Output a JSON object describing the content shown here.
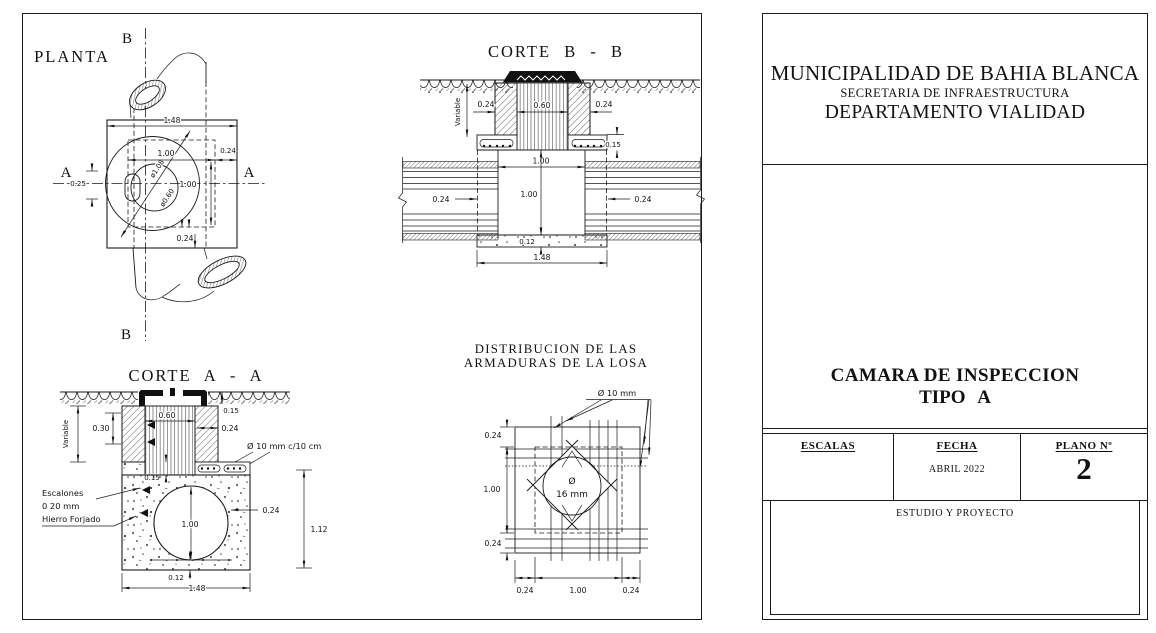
{
  "colors": {
    "line": "#1a1a1a",
    "background": "#ffffff"
  },
  "planta": {
    "title": "PLANTA",
    "section_b": "B",
    "section_a": "A",
    "dim_total_width": "1.48",
    "dim_inner_width": "1.00",
    "dim_wall_right": "0.24",
    "dim_inner_height": "1.00",
    "dim_step": "0.25",
    "dim_wall_bottom": "0.24",
    "dia_outer": "ø1.08",
    "dia_inner": "ø0.60"
  },
  "corte_bb": {
    "title": "CORTE B - B",
    "variable_label": "Variable",
    "dim_wall_left": "0.24",
    "dim_chimney": "0.60",
    "dim_wall_right": "0.24",
    "dim_slab": "0.15",
    "dim_inner_width": "1.00",
    "dim_inner_height": "1.00",
    "dim_pipe_left": "0.24",
    "dim_pipe_right": "0.24",
    "dim_floor": "0.12",
    "dim_total_width": "1.48"
  },
  "corte_aa": {
    "title": "CORTE A - A",
    "variable_label": "Variable",
    "dim_cover": "0.15",
    "dim_upper_wall": "0.30",
    "dim_chimney": "0.60",
    "dim_wall": "0.24",
    "rebar_label": "Ø 10 mm c/10 cm",
    "dim_slab": "0.15",
    "steps_line1": "Escalones",
    "steps_line2": "0 20 mm",
    "steps_line3": "Hierro Forjado",
    "dim_chamber": "1.00",
    "dim_wall_right": "0.24",
    "dim_height": "1.12",
    "dim_floor": "0.12",
    "dim_total_width": "1.48"
  },
  "distribucion": {
    "title_line1": "DISTRIBUCION DE LAS",
    "title_line2": "ARMADURAS DE LA LOSA",
    "rebar_top_label": "Ø 10 mm",
    "center_dia_symbol": "Ø",
    "center_dia_value": "16 mm",
    "dim_left_top": "0.24",
    "dim_left_mid": "1.00",
    "dim_left_bottom": "0.24",
    "dim_bottom_left": "0.24",
    "dim_bottom_mid": "1.00",
    "dim_bottom_right": "0.24"
  },
  "title_block": {
    "org_line1": "MUNICIPALIDAD DE BAHIA BLANCA",
    "org_line2": "SECRETARIA DE INFRAESTRUCTURA",
    "org_line3": "DEPARTAMENTO VIALIDAD",
    "drawing_title_line1": "CAMARA DE INSPECCION",
    "drawing_title_line2": "TIPO A",
    "escalas_label": "ESCALAS",
    "fecha_label": "FECHA",
    "fecha_value": "ABRIL 2022",
    "plano_label": "PLANO Nº",
    "plano_number": "2",
    "estudio_label": "ESTUDIO Y PROYECTO"
  }
}
